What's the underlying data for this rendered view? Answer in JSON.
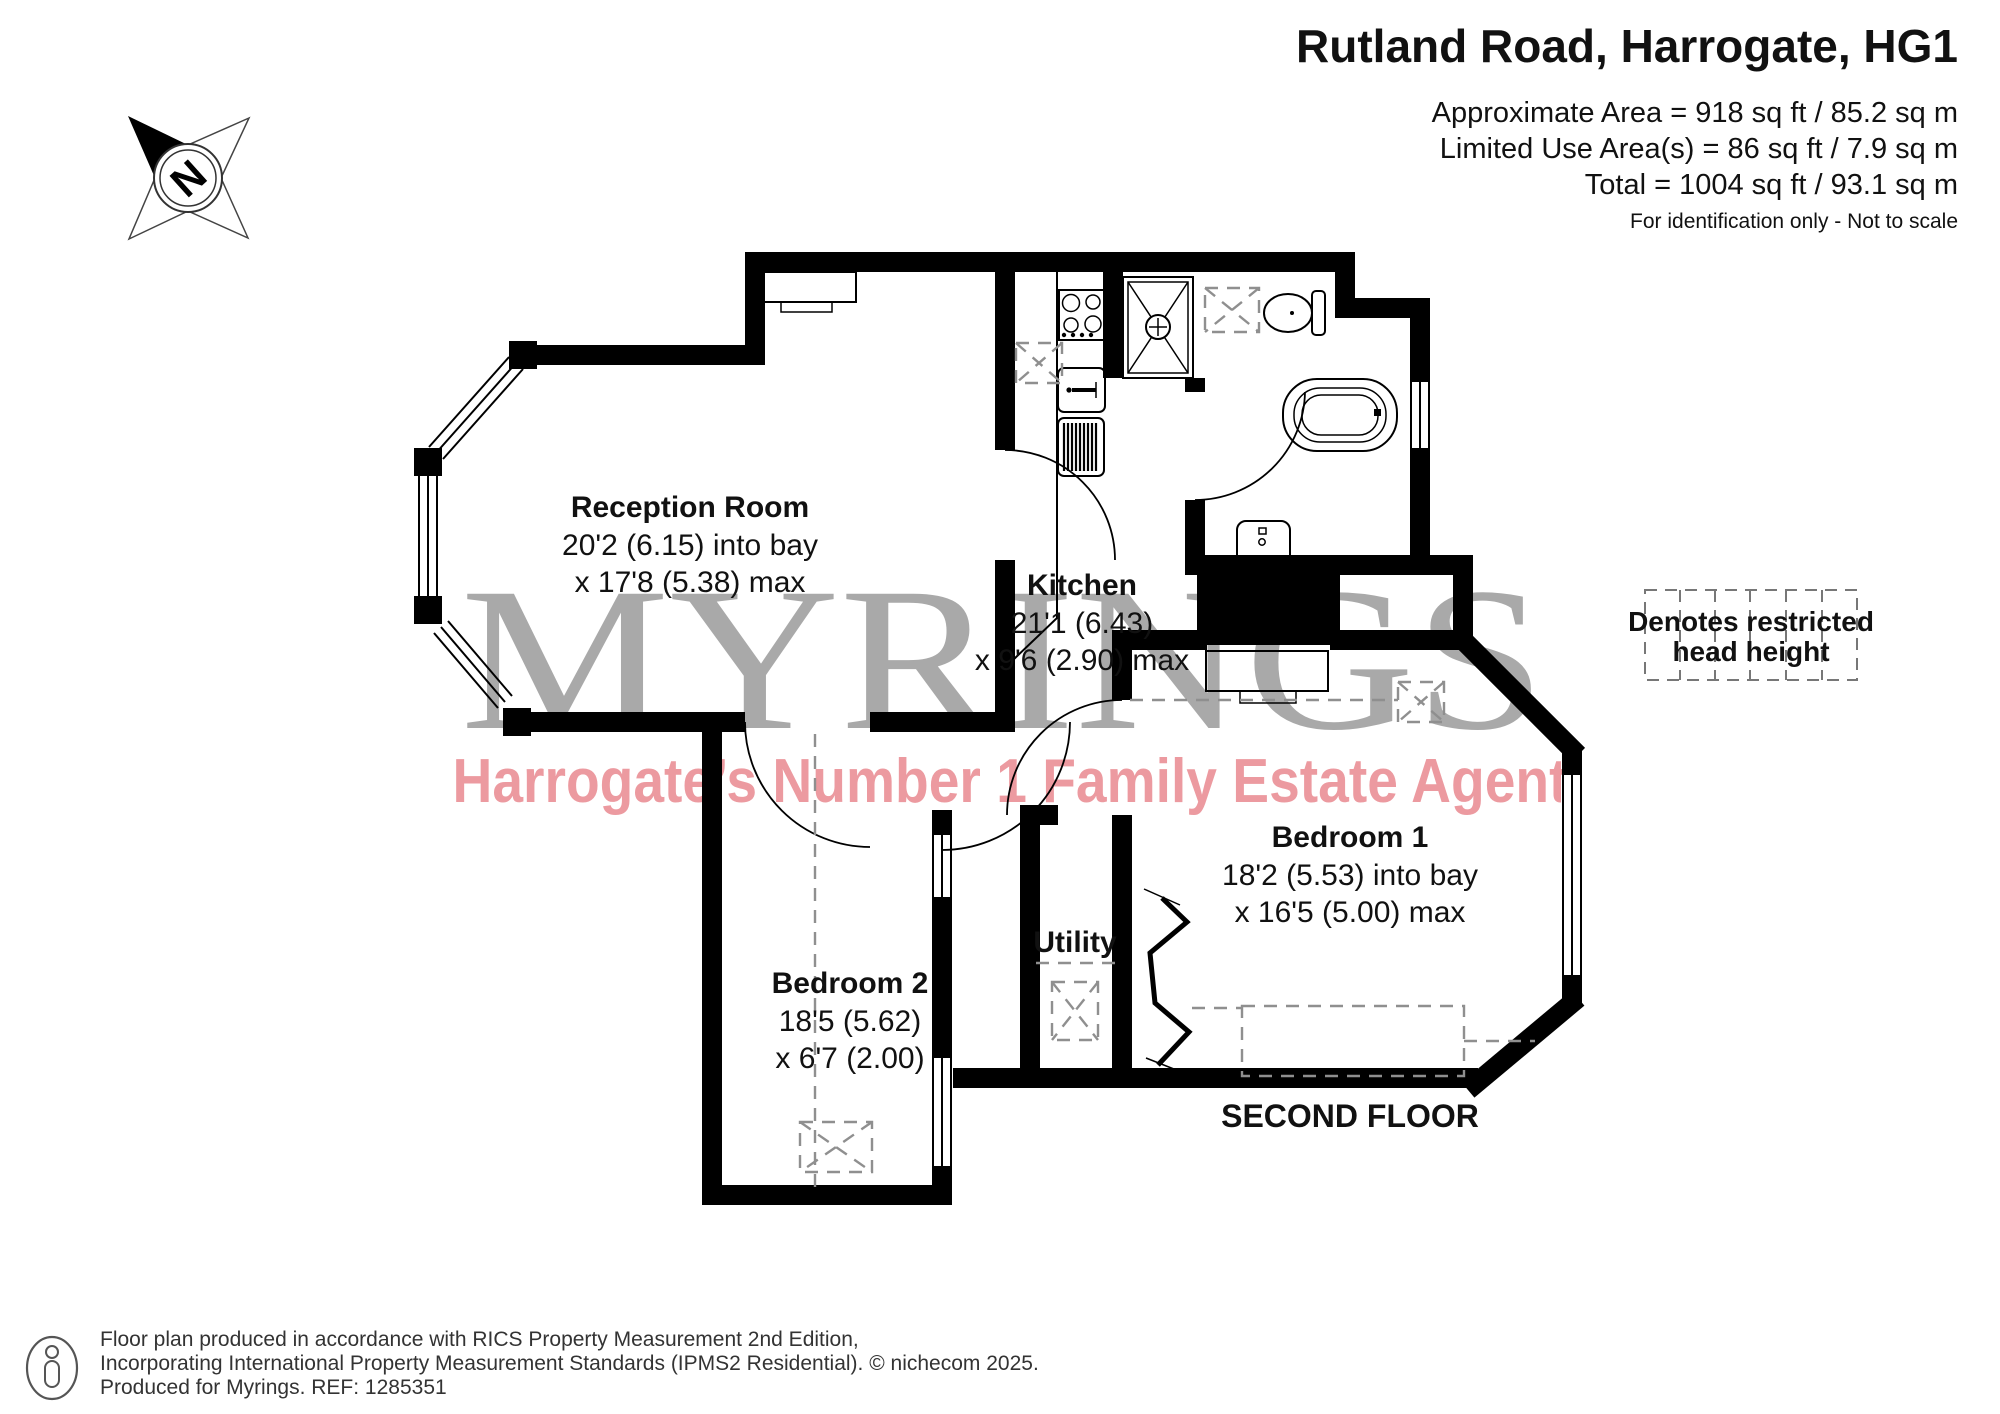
{
  "header": {
    "title": "Rutland Road, Harrogate, HG1",
    "area_line1": "Approximate Area = 918 sq ft / 85.2 sq m",
    "area_line2": "Limited Use Area(s) = 86 sq ft / 7.9 sq m",
    "area_line3": "Total = 1004 sq ft / 93.1 sq m",
    "note": "For identification only - Not to scale"
  },
  "compass": {
    "label": "N"
  },
  "watermark": {
    "brand": "MYRINGS",
    "slogan": "Harrogate’s Number 1 Family Estate Agent",
    "brand_color": "#a9a9a9",
    "slogan_color": "#ec9aa0"
  },
  "rooms": {
    "reception": {
      "name": "Reception Room",
      "dim1": "20'2 (6.15) into bay",
      "dim2": "x 17'8 (5.38) max"
    },
    "kitchen": {
      "name": "Kitchen",
      "dim1": "21'1 (6.43)",
      "dim2": "x 9'6 (2.90) max"
    },
    "bedroom1": {
      "name": "Bedroom 1",
      "dim1": "18'2 (5.53) into bay",
      "dim2": "x 16'5 (5.00) max"
    },
    "bedroom2": {
      "name": "Bedroom 2",
      "dim1": "18'5 (5.62)",
      "dim2": "x 6'7 (2.00)"
    },
    "utility": {
      "name": "Utility"
    }
  },
  "legend": {
    "line1": "Denotes restricted",
    "line2": "head height"
  },
  "floor_label": "SECOND FLOOR",
  "footer": {
    "line1": "Floor plan produced in accordance with RICS Property Measurement 2nd Edition,",
    "line2": "Incorporating International Property Measurement Standards (IPMS2 Residential).   © nichecom 2025.",
    "line3": "Produced for Myrings.   REF: 1285351"
  }
}
